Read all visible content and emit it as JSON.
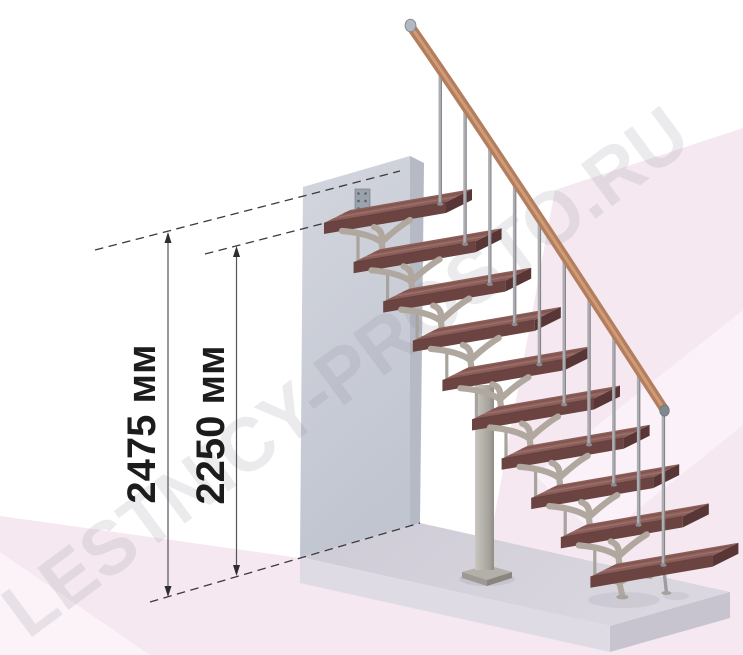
{
  "title": "10 ступеней",
  "watermark": "LESTNICY-PROSTO.RU",
  "diagram": {
    "type": "staircase-dimension-diagram",
    "step_count": 10,
    "dimensions": [
      {
        "label": "2475 мм",
        "value": 2475,
        "unit": "мм",
        "meaning": "height to upper floor level"
      },
      {
        "label": "2250 мм",
        "value": 2250,
        "unit": "мм",
        "meaning": "height to top step level"
      }
    ]
  },
  "colors": {
    "tread_top": "#9b6b65",
    "tread_top_dark": "#835450",
    "tread_front": "#6b4442",
    "tread_side": "#573635",
    "rail_wood": "#b47e5e",
    "rail_highlight": "#d2a17a",
    "metal_baluster": "#adadb2",
    "support_metal": "#b0a89e",
    "wall_light": "#d3d6de",
    "wall_dark": "#c1c5d0",
    "wall_side": "#b6bac4",
    "floor_top": "#d2cfd9",
    "floor_front": "#dedbe4",
    "floor_right": "#c7c4cf",
    "background_pink": "#f5e8f0",
    "background_pink_light": "#fbf3f8",
    "dimension_line": "#54545a",
    "dimension_text": "#1c1c1c",
    "watermark_gray": "#8a8792"
  }
}
